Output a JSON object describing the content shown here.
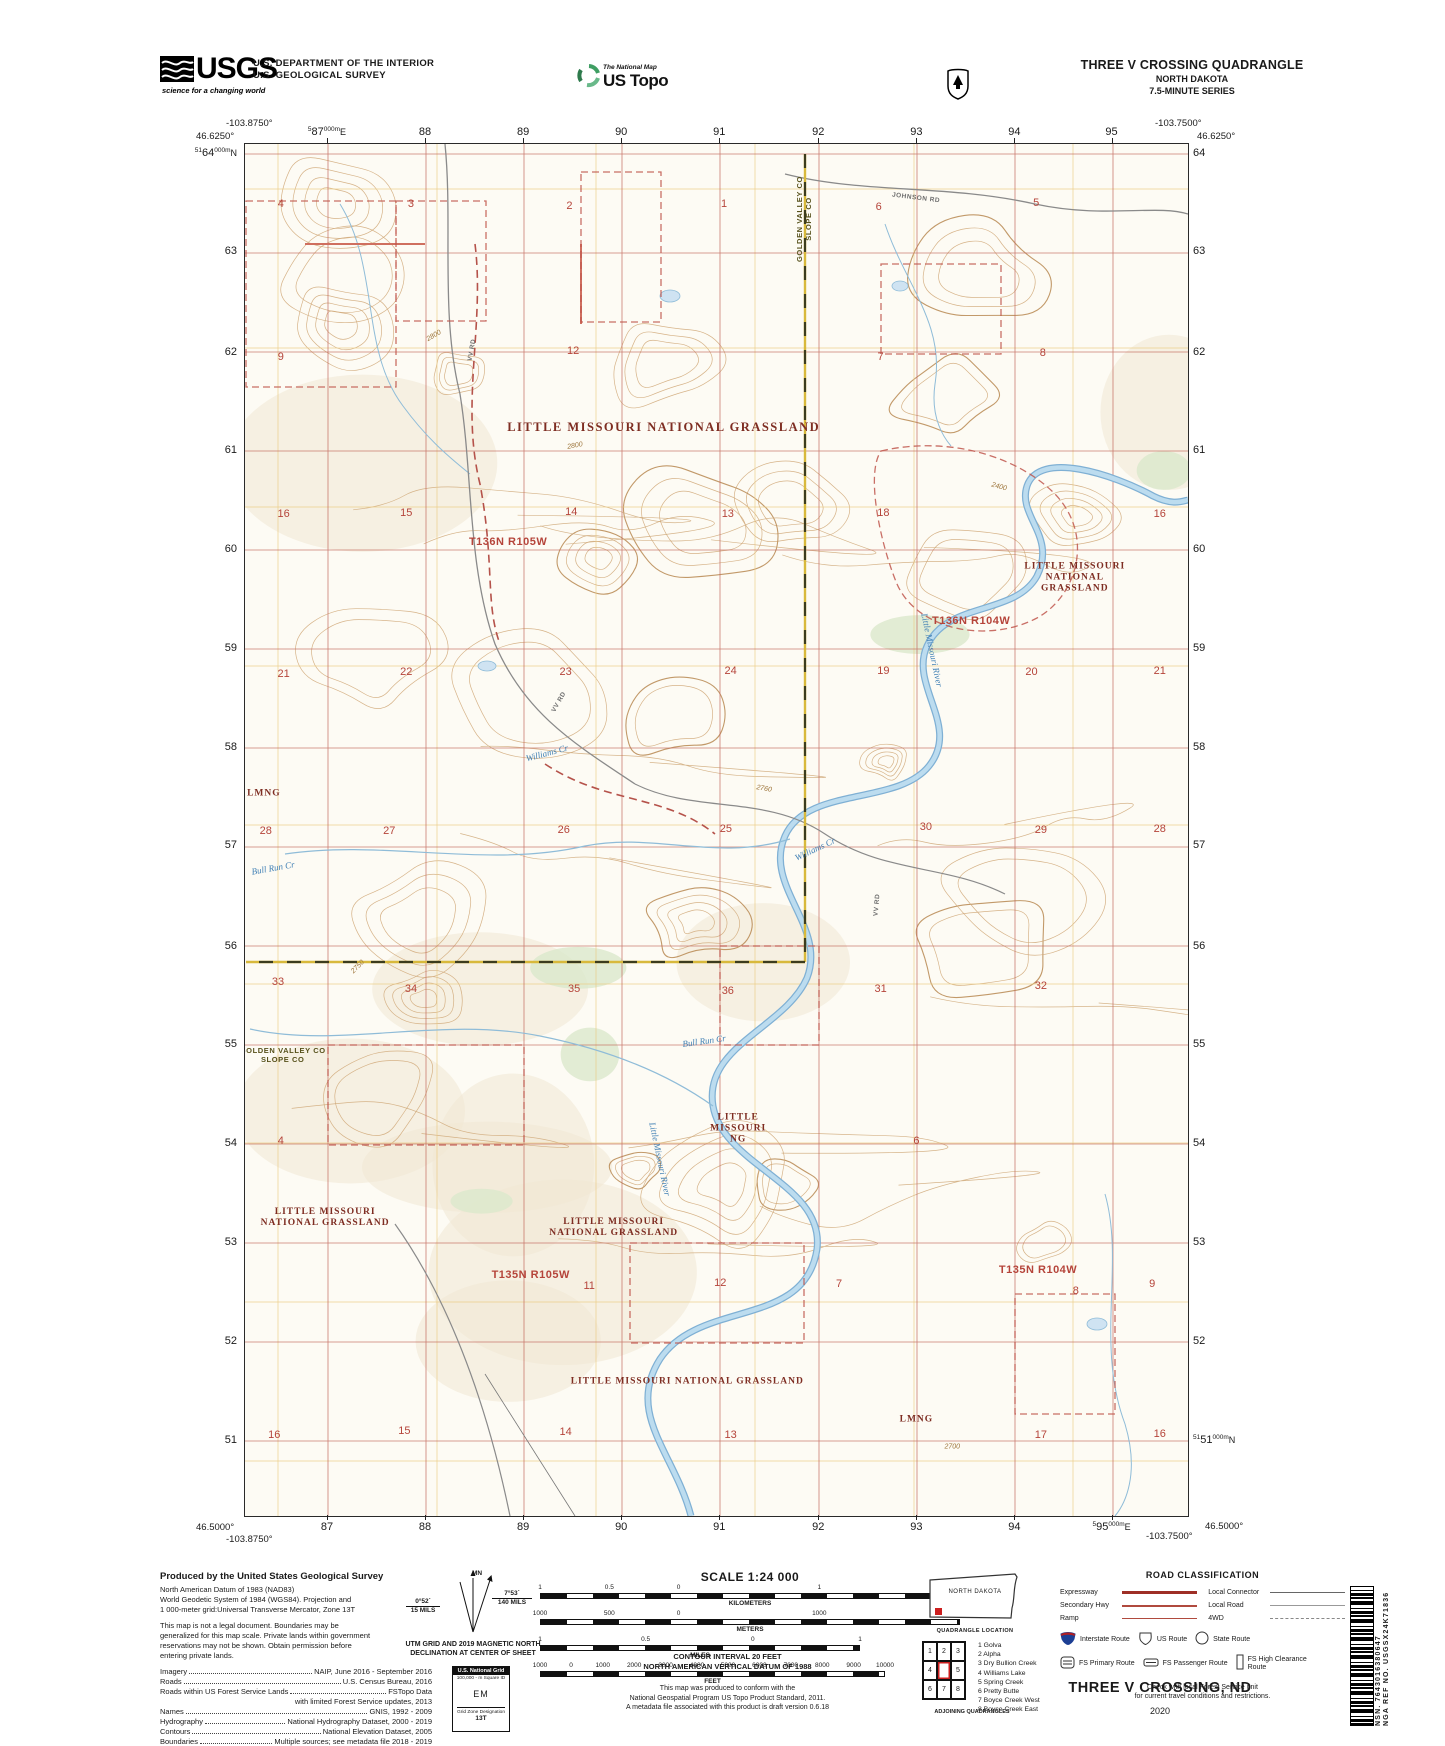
{
  "header": {
    "usgs_word": "USGS",
    "usgs_tagline": "science for a changing world",
    "agency_line1": "U.S. DEPARTMENT OF THE INTERIOR",
    "agency_line2": "U.S. GEOLOGICAL SURVEY",
    "ustopo_tagline": "The National Map",
    "ustopo_brand": "US Topo",
    "quad_title": "THREE V CROSSING QUADRANGLE",
    "quad_state": "NORTH DAKOTA",
    "quad_series": "7.5-MINUTE SERIES"
  },
  "map": {
    "corners": {
      "tl_lon": "-103.8750°",
      "tl_lat": "46.6250°",
      "tr_lon": "-103.7500°",
      "tr_lat": "46.6250°",
      "bl_lat": "46.5000°",
      "bl_lon": "-103.8750°",
      "br_lon": "-103.7500°",
      "br_lat": "46.5000°"
    },
    "edge_top": [
      {
        "sup1": "5",
        "big": "87",
        "sup2": "000m",
        "unit": "E",
        "p": 8.8
      },
      {
        "big": "88",
        "p": 19.2
      },
      {
        "big": "89",
        "p": 29.6
      },
      {
        "big": "90",
        "p": 40.0
      },
      {
        "big": "91",
        "p": 50.4
      },
      {
        "big": "92",
        "p": 60.9
      },
      {
        "big": "93",
        "p": 71.3
      },
      {
        "big": "94",
        "p": 81.7
      },
      {
        "big": "95",
        "p": 92.0
      }
    ],
    "edge_bottom": [
      {
        "big": "87",
        "p": 8.8
      },
      {
        "big": "88",
        "p": 19.2
      },
      {
        "big": "89",
        "p": 29.6
      },
      {
        "big": "90",
        "p": 40.0
      },
      {
        "big": "91",
        "p": 50.4
      },
      {
        "big": "92",
        "p": 60.9
      },
      {
        "big": "93",
        "p": 71.3
      },
      {
        "big": "94",
        "p": 81.7
      },
      {
        "sup1": "5",
        "big": "95",
        "sup2": "000m",
        "unit": "E",
        "p": 92.0
      }
    ],
    "edge_left": [
      {
        "sup1": "51",
        "big": "64",
        "sup2": "000m",
        "unit": "N",
        "p": 0.7
      },
      {
        "big": "63",
        "p": 7.9
      },
      {
        "big": "62",
        "p": 15.2
      },
      {
        "big": "61",
        "p": 22.4
      },
      {
        "big": "60",
        "p": 29.6
      },
      {
        "big": "59",
        "p": 36.8
      },
      {
        "big": "58",
        "p": 44.0
      },
      {
        "big": "57",
        "p": 51.2
      },
      {
        "big": "56",
        "p": 58.5
      },
      {
        "big": "55",
        "p": 65.7
      },
      {
        "big": "54",
        "p": 72.9
      },
      {
        "big": "53",
        "p": 80.1
      },
      {
        "big": "52",
        "p": 87.3
      },
      {
        "big": "51",
        "p": 94.5
      }
    ],
    "edge_right": [
      {
        "big": "64",
        "p": 0.7
      },
      {
        "big": "63",
        "p": 7.9
      },
      {
        "big": "62",
        "p": 15.2
      },
      {
        "big": "61",
        "p": 22.4
      },
      {
        "big": "60",
        "p": 29.6
      },
      {
        "big": "59",
        "p": 36.8
      },
      {
        "big": "58",
        "p": 44.0
      },
      {
        "big": "57",
        "p": 51.2
      },
      {
        "big": "56",
        "p": 58.5
      },
      {
        "big": "55",
        "p": 65.7
      },
      {
        "big": "54",
        "p": 72.9
      },
      {
        "big": "53",
        "p": 80.1
      },
      {
        "big": "52",
        "p": 87.3
      },
      {
        "sup1": "51",
        "big": "51",
        "sup2": "000m",
        "unit": "N",
        "p": 94.5
      }
    ],
    "labels": [
      {
        "t": "LITTLE MISSOURI NATIONAL GRASSLAND",
        "x": 44.4,
        "y": 20.6,
        "cls": "grassland"
      },
      {
        "t": "LITTLE MISSOURI\nNATIONAL\nGRASSLAND",
        "x": 88.0,
        "y": 31.6,
        "cls": "grassland-sm"
      },
      {
        "t": "LMNG",
        "x": 2.0,
        "y": 47.4,
        "cls": "grassland-sm"
      },
      {
        "t": "LITTLE\nMISSOURI\nNG",
        "x": 52.3,
        "y": 71.8,
        "cls": "grassland-sm"
      },
      {
        "t": "LITTLE MISSOURI\nNATIONAL GRASSLAND",
        "x": 8.5,
        "y": 78.3,
        "cls": "grassland-sm"
      },
      {
        "t": "LITTLE MISSOURI\nNATIONAL GRASSLAND",
        "x": 39.1,
        "y": 79.0,
        "cls": "grassland-sm"
      },
      {
        "t": "LITTLE MISSOURI NATIONAL GRASSLAND",
        "x": 46.9,
        "y": 90.2,
        "cls": "grassland-sm"
      },
      {
        "t": "LMNG",
        "x": 71.2,
        "y": 93.0,
        "cls": "grassland-sm"
      },
      {
        "t": "T136N R105W",
        "x": 27.9,
        "y": 29.0,
        "cls": "township"
      },
      {
        "t": "T136N R104W",
        "x": 77.0,
        "y": 34.8,
        "cls": "township"
      },
      {
        "t": "T135N R105W",
        "x": 30.3,
        "y": 82.4,
        "cls": "township"
      },
      {
        "t": "T135N R104W",
        "x": 84.1,
        "y": 82.1,
        "cls": "township"
      },
      {
        "t": "GOLDEN VALLEY CO\nSLOPE CO",
        "x": 59.3,
        "y": 5.5,
        "cls": "county",
        "rot": -90
      },
      {
        "t": "GOLDEN VALLEY CO\nSLOPE CO",
        "x": 4.0,
        "y": 66.4,
        "cls": "county"
      },
      {
        "t": "JOHNSON RD",
        "x": 71.2,
        "y": 3.9,
        "cls": "road",
        "rot": 7
      },
      {
        "t": "VV RD",
        "x": 24.1,
        "y": 15.0,
        "cls": "road",
        "rot": -80
      },
      {
        "t": "VV RD",
        "x": 33.3,
        "y": 40.7,
        "cls": "road",
        "rot": -60
      },
      {
        "t": "VV RD",
        "x": 67.0,
        "y": 55.5,
        "cls": "road",
        "rot": -85
      },
      {
        "t": "Williams Cr",
        "x": 32.0,
        "y": 44.4,
        "cls": "stream",
        "rot": -15
      },
      {
        "t": "Williams Cr",
        "x": 60.4,
        "y": 51.4,
        "cls": "stream",
        "rot": -25
      },
      {
        "t": "Bull Run Cr",
        "x": 3.0,
        "y": 52.8,
        "cls": "stream",
        "rot": -10
      },
      {
        "t": "Bull Run Cr",
        "x": 48.7,
        "y": 65.4,
        "cls": "stream",
        "rot": -8
      },
      {
        "t": "Little Missouri River",
        "x": 72.9,
        "y": 36.9,
        "cls": "stream",
        "rot": 78
      },
      {
        "t": "Little Missouri River",
        "x": 44.0,
        "y": 74.0,
        "cls": "stream",
        "rot": 78
      },
      {
        "t": "2800",
        "x": 20.0,
        "y": 14.0,
        "cls": "contour",
        "rot": -30
      },
      {
        "t": "2800",
        "x": 35.0,
        "y": 22.0,
        "cls": "contour",
        "rot": -10
      },
      {
        "t": "2400",
        "x": 80.0,
        "y": 25.0,
        "cls": "contour",
        "rot": 15
      },
      {
        "t": "2750",
        "x": 12.0,
        "y": 60.0,
        "cls": "contour",
        "rot": -45
      },
      {
        "t": "2760",
        "x": 55.0,
        "y": 47.0,
        "cls": "contour",
        "rot": 10
      },
      {
        "t": "2700",
        "x": 75.0,
        "y": 95.0,
        "cls": "contour",
        "rot": 0
      }
    ],
    "sections": [
      {
        "n": "4",
        "x": 3.8,
        "y": 4.4
      },
      {
        "n": "3",
        "x": 17.6,
        "y": 4.4
      },
      {
        "n": "2",
        "x": 34.4,
        "y": 4.5
      },
      {
        "n": "1",
        "x": 50.8,
        "y": 4.4
      },
      {
        "n": "6",
        "x": 67.2,
        "y": 4.6
      },
      {
        "n": "5",
        "x": 83.9,
        "y": 4.3
      },
      {
        "n": "9",
        "x": 3.8,
        "y": 15.5
      },
      {
        "n": "12",
        "x": 34.8,
        "y": 15.1
      },
      {
        "n": "7",
        "x": 67.4,
        "y": 15.5
      },
      {
        "n": "8",
        "x": 84.6,
        "y": 15.2
      },
      {
        "n": "16",
        "x": 4.1,
        "y": 27.0
      },
      {
        "n": "15",
        "x": 17.1,
        "y": 26.9
      },
      {
        "n": "14",
        "x": 34.6,
        "y": 26.8
      },
      {
        "n": "13",
        "x": 51.2,
        "y": 27.0
      },
      {
        "n": "18",
        "x": 67.7,
        "y": 26.9
      },
      {
        "n": "16",
        "x": 97.0,
        "y": 27.0
      },
      {
        "n": "21",
        "x": 4.1,
        "y": 38.6
      },
      {
        "n": "22",
        "x": 17.1,
        "y": 38.5
      },
      {
        "n": "23",
        "x": 34.0,
        "y": 38.5
      },
      {
        "n": "24",
        "x": 51.5,
        "y": 38.4
      },
      {
        "n": "19",
        "x": 67.7,
        "y": 38.4
      },
      {
        "n": "20",
        "x": 83.4,
        "y": 38.5
      },
      {
        "n": "21",
        "x": 97.0,
        "y": 38.4
      },
      {
        "n": "28",
        "x": 2.2,
        "y": 50.1
      },
      {
        "n": "27",
        "x": 15.3,
        "y": 50.1
      },
      {
        "n": "26",
        "x": 33.8,
        "y": 50.0
      },
      {
        "n": "25",
        "x": 51.0,
        "y": 49.9
      },
      {
        "n": "30",
        "x": 72.2,
        "y": 49.8
      },
      {
        "n": "29",
        "x": 84.4,
        "y": 50.0
      },
      {
        "n": "28",
        "x": 97.0,
        "y": 49.9
      },
      {
        "n": "33",
        "x": 3.5,
        "y": 61.1
      },
      {
        "n": "34",
        "x": 17.6,
        "y": 61.6
      },
      {
        "n": "35",
        "x": 34.9,
        "y": 61.6
      },
      {
        "n": "36",
        "x": 51.2,
        "y": 61.7
      },
      {
        "n": "31",
        "x": 67.4,
        "y": 61.6
      },
      {
        "n": "32",
        "x": 84.4,
        "y": 61.4
      },
      {
        "n": "4",
        "x": 3.8,
        "y": 72.7
      },
      {
        "n": "6",
        "x": 71.2,
        "y": 72.7
      },
      {
        "n": "11",
        "x": 36.5,
        "y": 83.2
      },
      {
        "n": "12",
        "x": 50.4,
        "y": 83.0
      },
      {
        "n": "7",
        "x": 63.0,
        "y": 83.1
      },
      {
        "n": "8",
        "x": 88.1,
        "y": 83.6
      },
      {
        "n": "9",
        "x": 96.2,
        "y": 83.1
      },
      {
        "n": "16",
        "x": 3.1,
        "y": 94.1
      },
      {
        "n": "15",
        "x": 16.9,
        "y": 93.8
      },
      {
        "n": "14",
        "x": 34.0,
        "y": 93.9
      },
      {
        "n": "13",
        "x": 51.5,
        "y": 94.1
      },
      {
        "n": "17",
        "x": 84.4,
        "y": 94.1
      },
      {
        "n": "16",
        "x": 97.0,
        "y": 94.0
      }
    ]
  },
  "footer": {
    "produced": {
      "title": "Produced by the United States Geological Survey",
      "datum_lines": [
        "North American Datum of 1983 (NAD83)",
        "World Geodetic System of 1984 (WGS84).  Projection and",
        "1 000-meter grid:Universal Transverse Mercator, Zone 13T"
      ],
      "legal_lines": [
        "This map is not a legal document. Boundaries may be",
        "generalized for this map scale. Private lands within government",
        "reservations may not be shown. Obtain permission before",
        "entering private lands."
      ],
      "credits": [
        {
          "k": "Imagery",
          "v": "NAIP, June 2016 - September 2016"
        },
        {
          "k": "Roads",
          "v": "U.S. Census Bureau, 2016"
        },
        {
          "k": "Roads within US Forest Service Lands",
          "v": "FSTopo Data"
        },
        {
          "k": "",
          "v": "with limited Forest Service updates, 2013"
        },
        {
          "k": "Names",
          "v": "GNIS, 1992 - 2009"
        },
        {
          "k": "Hydrography",
          "v": "National Hydrography Dataset, 2000 - 2019"
        },
        {
          "k": "Contours",
          "v": "National Elevation Dataset, 2005"
        },
        {
          "k": "Boundaries",
          "v": "Multiple sources; see metadata file 2018 - 2019"
        },
        {
          "k": "Public Land Survey System",
          "v": "BLM, 2018"
        },
        {
          "k": "Wetlands",
          "v": "FWS National Wetlands Inventory 1983"
        }
      ]
    },
    "declination": {
      "gn_value": "0°52´",
      "gn_mils": "15 MILS",
      "mn_label": "MN",
      "mn_value": "7°53´",
      "mn_mils": "140 MILS",
      "caption_l1": "UTM GRID AND 2019 MAGNETIC NORTH",
      "caption_l2": "DECLINATION AT CENTER OF SHEET"
    },
    "usng": {
      "title": "U.S. National Grid",
      "sub": "100,000 - m Square ID",
      "square": "EM",
      "zone_label": "Grid Zone Designation",
      "zone": "13T"
    },
    "scale": {
      "title": "SCALE 1:24 000",
      "bars": [
        {
          "unit": "KILOMETERS",
          "width": 420,
          "ticks": [
            {
              "t": "1",
              "p": 0
            },
            {
              "t": "0.5",
              "p": 16.5
            },
            {
              "t": "0",
              "p": 33
            },
            {
              "t": "1",
              "p": 66.5
            },
            {
              "t": "2",
              "p": 100
            }
          ]
        },
        {
          "unit": "METERS",
          "width": 420,
          "ticks": [
            {
              "t": "1000",
              "p": 0
            },
            {
              "t": "500",
              "p": 16.5
            },
            {
              "t": "0",
              "p": 33
            },
            {
              "t": "1000",
              "p": 66.5
            },
            {
              "t": "2000",
              "p": 100
            }
          ]
        },
        {
          "unit": "MILES",
          "width": 320,
          "ticks": [
            {
              "t": "1",
              "p": 0
            },
            {
              "t": "0.5",
              "p": 33
            },
            {
              "t": "0",
              "p": 66.5
            },
            {
              "t": "1",
              "p": 100
            }
          ]
        },
        {
          "unit": "FEET",
          "width": 345,
          "ticks": [
            {
              "t": "1000",
              "p": 0
            },
            {
              "t": "0",
              "p": 9
            },
            {
              "t": "1000",
              "p": 18.2
            },
            {
              "t": "2000",
              "p": 27.3
            },
            {
              "t": "3000",
              "p": 36.4
            },
            {
              "t": "4000",
              "p": 45.5
            },
            {
              "t": "5000",
              "p": 54.5
            },
            {
              "t": "6000",
              "p": 63.6
            },
            {
              "t": "7000",
              "p": 72.7
            },
            {
              "t": "8000",
              "p": 81.8
            },
            {
              "t": "9000",
              "p": 90.9
            },
            {
              "t": "10000",
              "p": 100
            }
          ]
        }
      ]
    },
    "notes": {
      "contour_l1": "CONTOUR INTERVAL 20 FEET",
      "contour_l2": "NORTH AMERICAN VERTICAL DATUM OF 1988",
      "product_l1": "This map was produced to conform with the",
      "product_l2": "National Geospatial Program US Topo Product Standard, 2011.",
      "product_l3": "A metadata file associated with this product is draft version 0.6.18"
    },
    "location": {
      "state": "NORTH DAKOTA",
      "caption": "QUADRANGLE LOCATION"
    },
    "adjoining": {
      "cells": [
        "1",
        "2",
        "3",
        "4",
        "",
        "5",
        "6",
        "7",
        "8"
      ],
      "list": [
        "1 Golva",
        "2 Alpha",
        "3 Dry Bullion Creek",
        "4 Williams Lake",
        "5 Spring Creek",
        "6 Pretty Butte",
        "7 Boyce Creek West",
        "8 Boyce Creek East"
      ],
      "caption": "ADJOINING QUADRANGLES"
    },
    "roadclass": {
      "title": "ROAD CLASSIFICATION",
      "lines_left": [
        {
          "label": "Expressway",
          "style": "expressway"
        },
        {
          "label": "Secondary Hwy",
          "style": "secondary"
        },
        {
          "label": "Ramp",
          "style": "ramp"
        }
      ],
      "lines_right": [
        {
          "label": "Local Connector",
          "style": "connector"
        },
        {
          "label": "Local Road",
          "style": "local"
        },
        {
          "label": "4WD",
          "style": "fwd"
        }
      ],
      "shield_row1": [
        {
          "label": "Interstate Route",
          "icon": "interstate-shield"
        },
        {
          "label": "US Route",
          "icon": "us-route-shield"
        },
        {
          "label": "State Route",
          "icon": "state-route-circle"
        }
      ],
      "shield_row2": [
        {
          "label": "FS Primary Route",
          "icon": "fs-primary-badge"
        },
        {
          "label": "FS Passenger Route",
          "icon": "fs-passenger-badge"
        },
        {
          "label": "FS High Clearance Route",
          "icon": "fs-high-clearance-badge"
        }
      ],
      "note_l1": "Check with local Forest Service unit",
      "note_l2": "for current travel conditions and restrictions."
    },
    "titleblock": {
      "title": "THREE V CROSSING,  ND",
      "year": "2020"
    },
    "idblock": {
      "nsn_label": "NSN.",
      "nsn": "7643016380647",
      "nga_label": "NGA REF NO.",
      "nga": "USGSX24K71836"
    }
  },
  "colors": {
    "utm_grid": "#c2685c",
    "section_grid": "#eccb82",
    "contour": "#d2ab7c",
    "contour_index": "#bb8e5a",
    "water": "#bcdcef",
    "water_edge": "#7fb0d4",
    "boundary_red": "#c0564c",
    "county_yellow": "#d8b93c",
    "label_red": "#b5443a",
    "grassland_red": "#7e2d22"
  }
}
